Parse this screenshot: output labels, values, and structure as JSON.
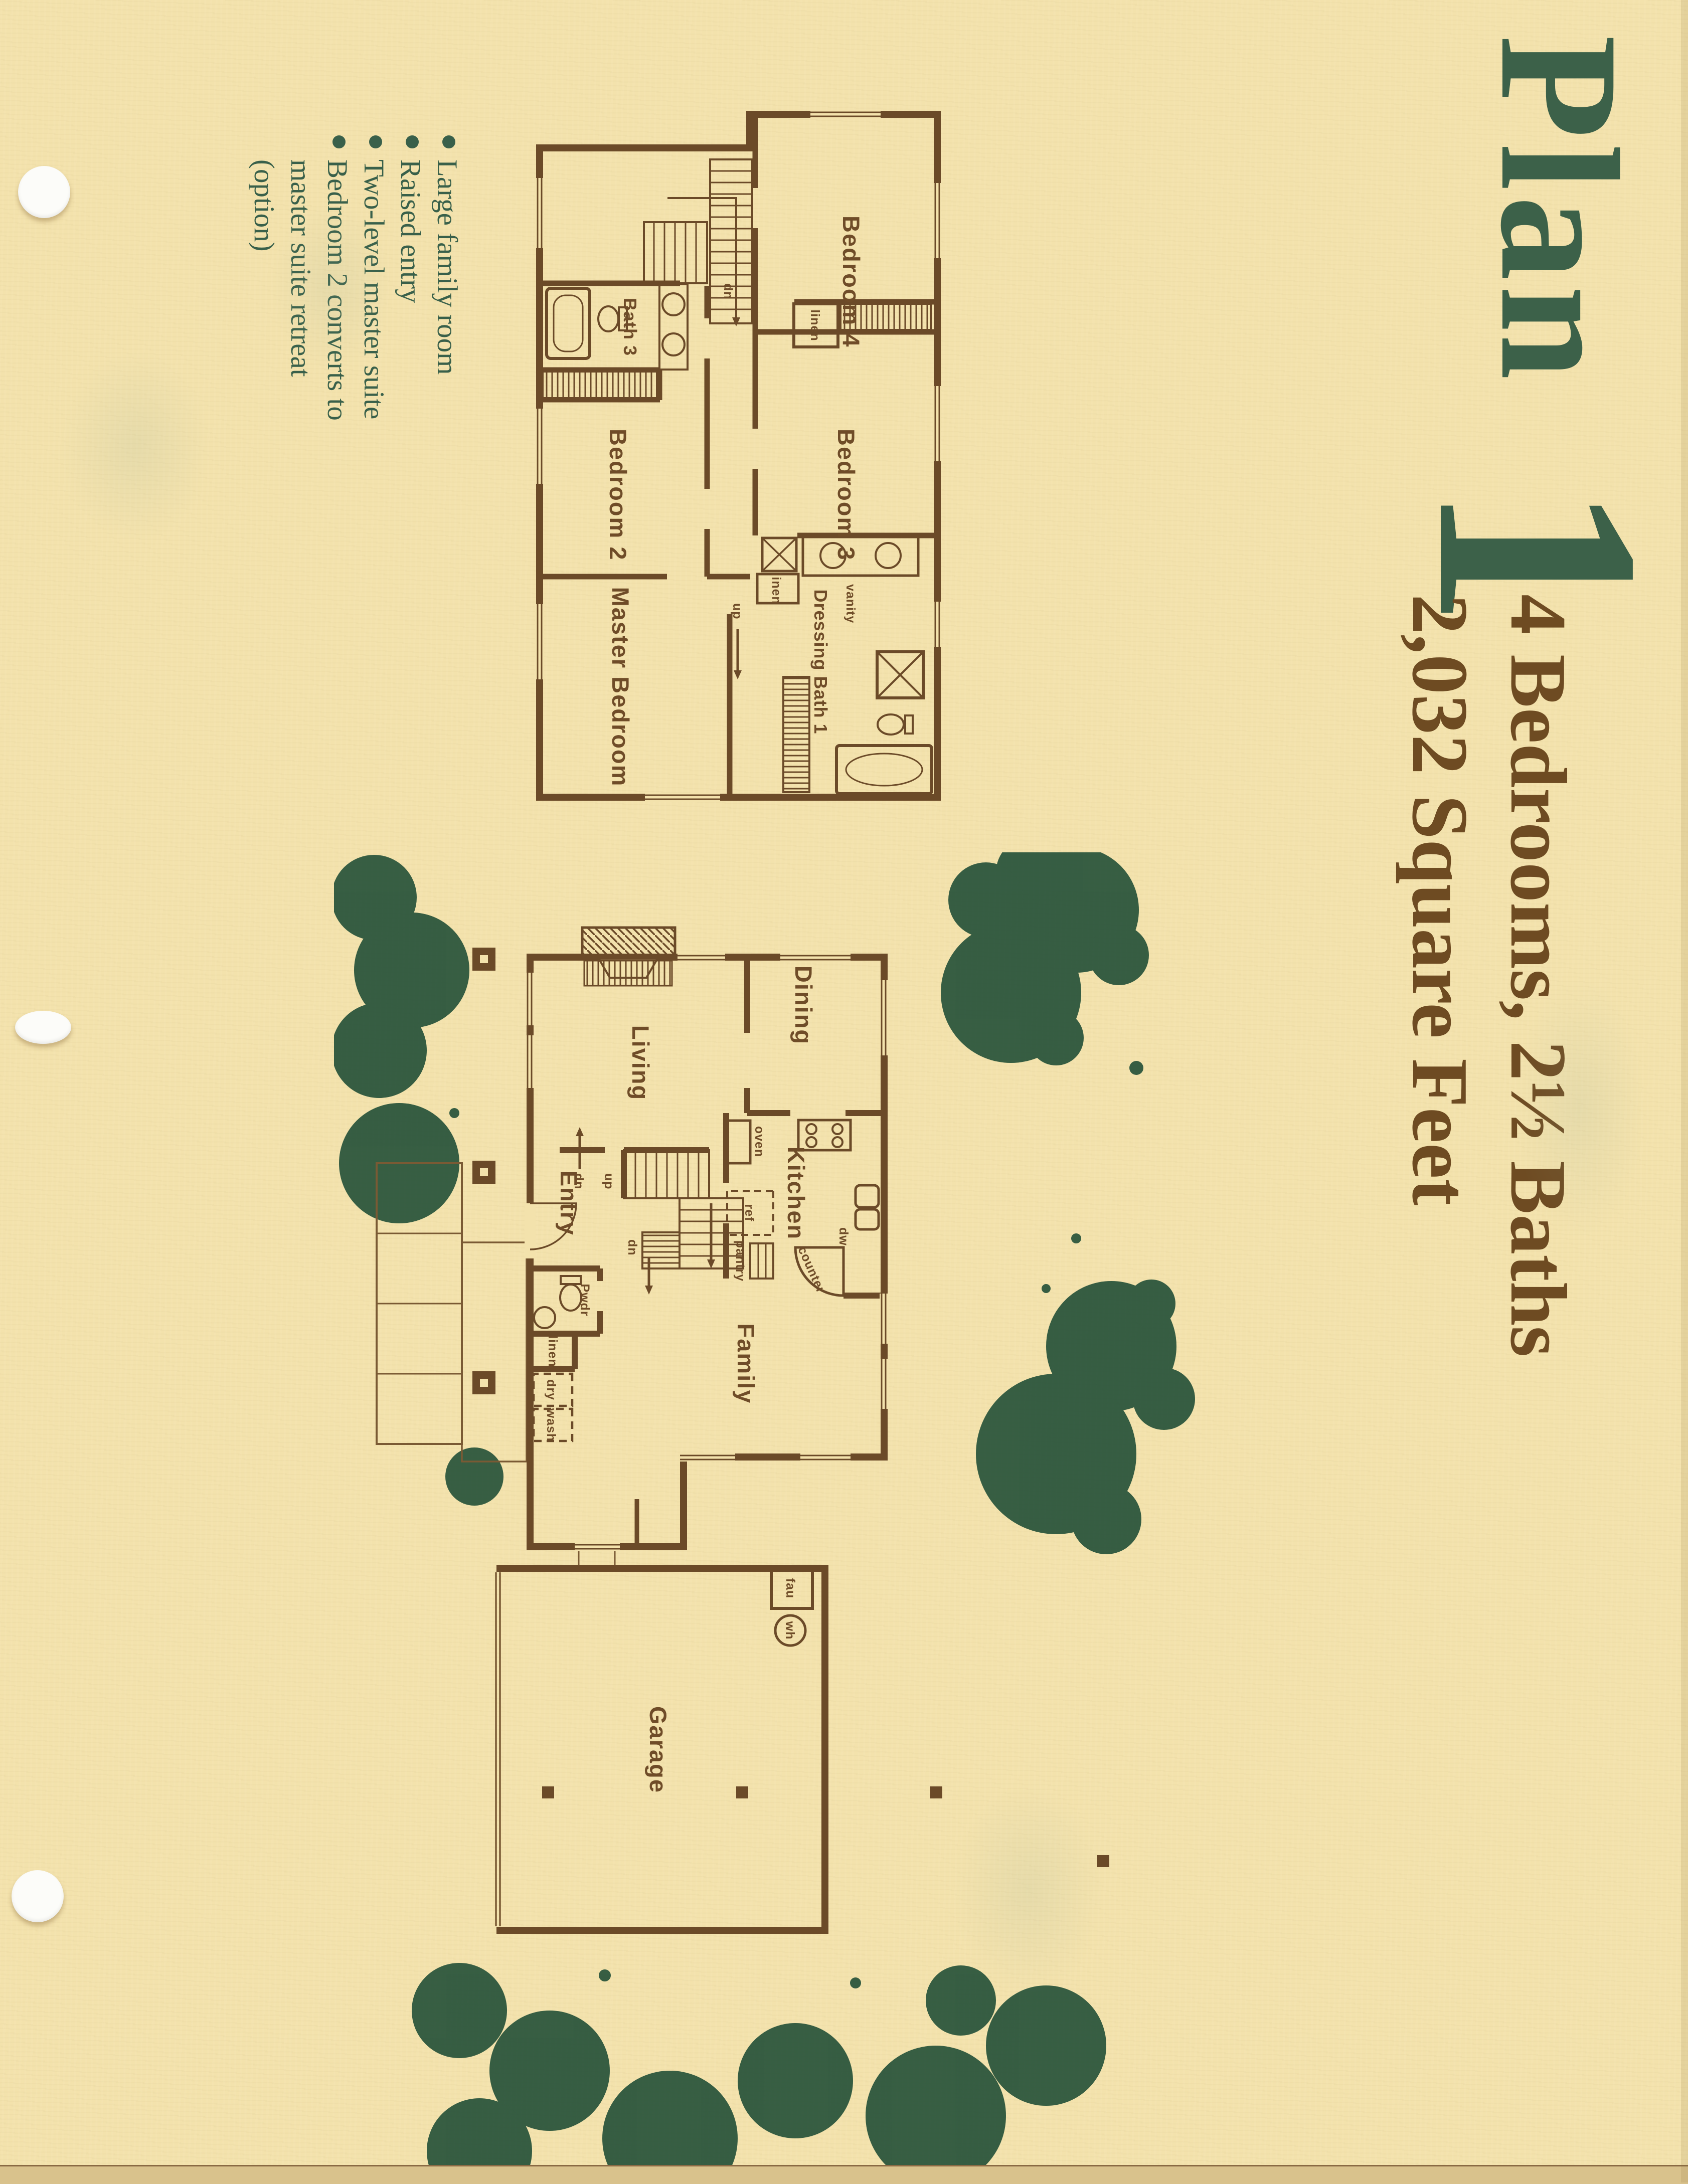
{
  "title": {
    "word": "Plan",
    "number": "1"
  },
  "subtitle": {
    "line1": "4 Bedrooms, 2½ Baths",
    "line2": "2,032 Square Feet"
  },
  "features": {
    "items": [
      "Large family room",
      "Raised entry",
      "Two-level master suite",
      "Bedroom 2 converts to master suite retreat (option)"
    ]
  },
  "upper_plan": {
    "labels": {
      "bedroom4": "Bedroom 4",
      "bedroom3": "Bedroom 3",
      "bedroom2": "Bedroom 2",
      "master_bedroom": "Master Bedroom",
      "bath3": "Bath 3",
      "dressing_bath1": "Dressing Bath 1",
      "vanity": "vanity",
      "linen": "linen",
      "up": "up",
      "dn": "dn"
    }
  },
  "main_plan": {
    "labels": {
      "living": "Living",
      "dining": "Dining",
      "kitchen": "Kitchen",
      "entry": "Entry",
      "family": "Family",
      "garage": "Garage",
      "pwdr": "Pwdr",
      "oven": "oven",
      "ref": "ref",
      "pantry": "pantry",
      "dw": "dw",
      "counter": "counter",
      "linen": "linen",
      "dry": "dry",
      "wash": "wash",
      "fau": "fau",
      "wh": "wh",
      "up": "up",
      "dn": "dn"
    }
  },
  "colors": {
    "paper": "#f3e2ac",
    "title_green": "#3c6149",
    "text_brown": "#6e4b22",
    "wall_brown": "#6b4a28",
    "tree_green": "#27523a"
  }
}
